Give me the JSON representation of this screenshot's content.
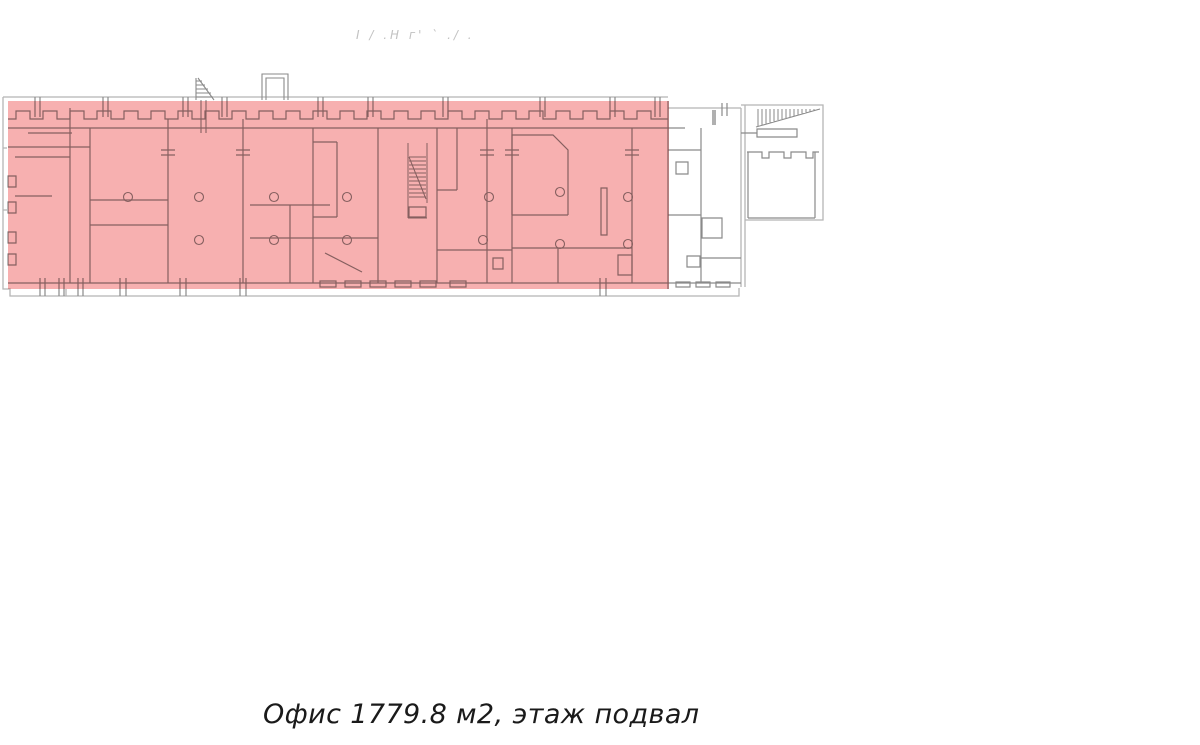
{
  "plan": {
    "caption": "Офис 1779.8 м2, этаж подвал",
    "area_m2": "1779.8",
    "floor": "подвал",
    "object_type": "Офис",
    "faint_annotation": "І / .Н г' ` ./ .",
    "colors": {
      "highlight": "#f7b0b0",
      "outline": "#b5b5b5",
      "walls": "#8a8a8a",
      "caption_text": "#1a1a1a",
      "annotation_text": "#c2c2c2"
    }
  }
}
